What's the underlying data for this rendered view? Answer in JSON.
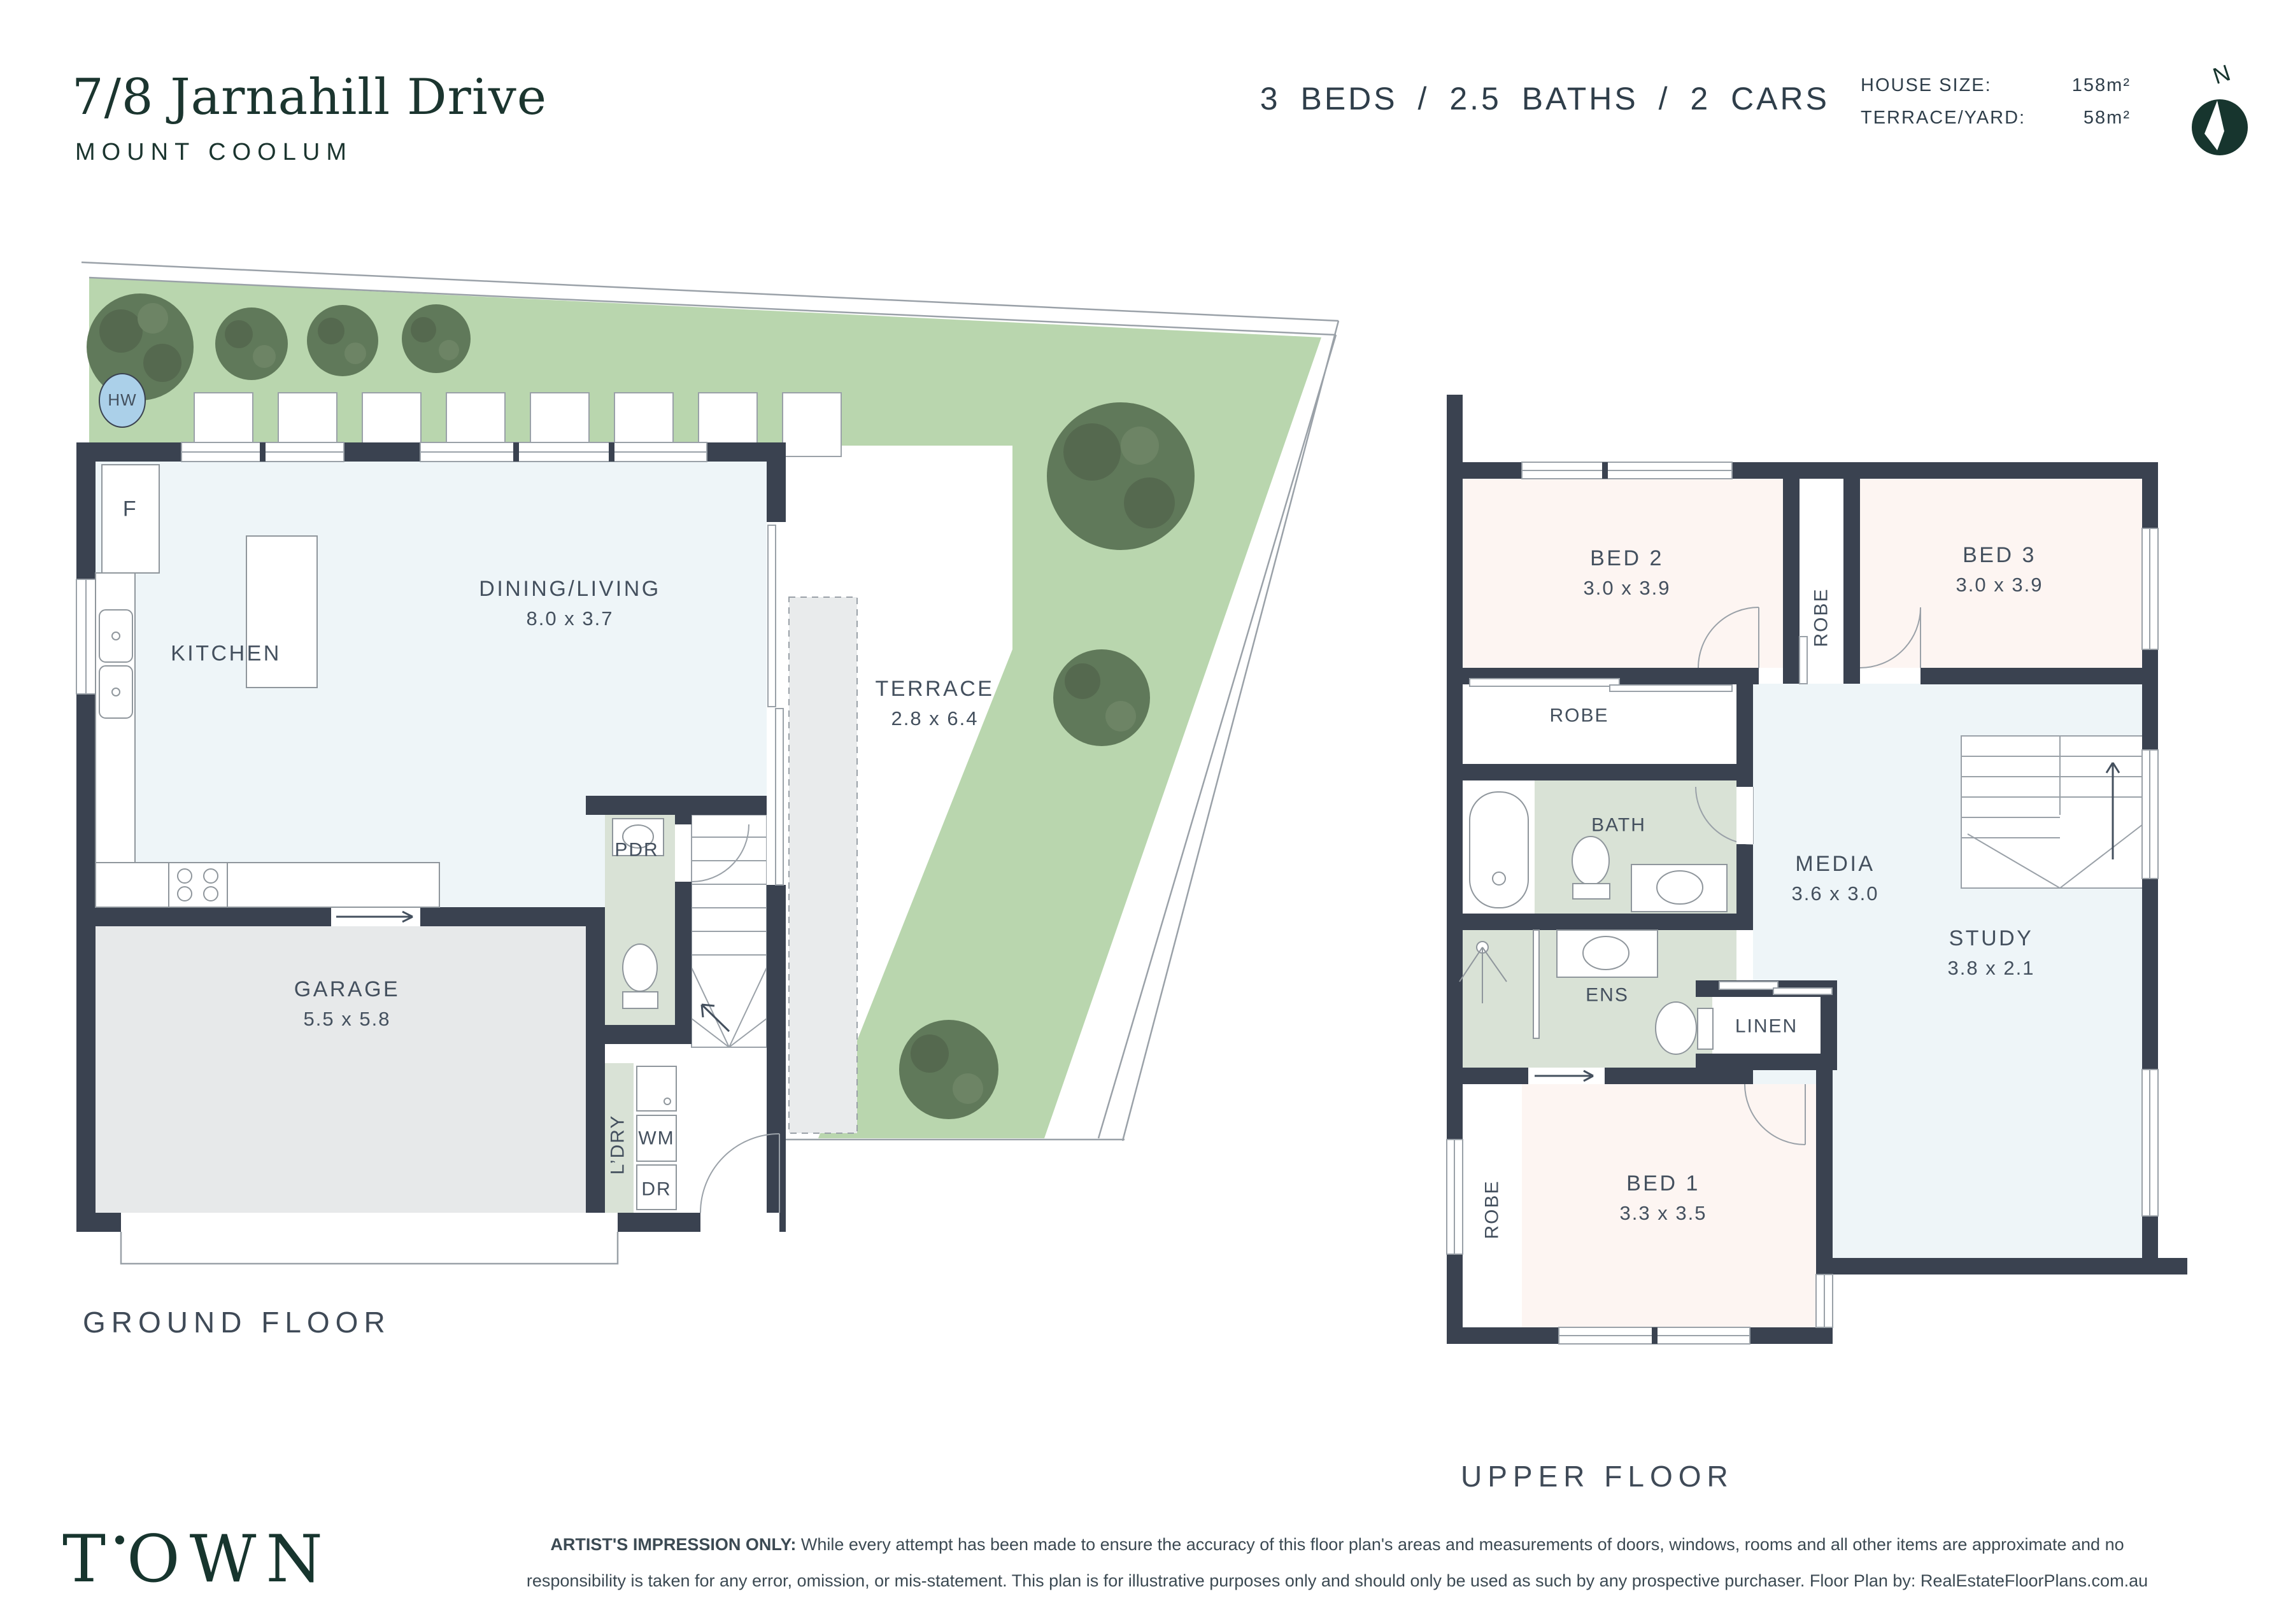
{
  "header": {
    "address_line1": "7/8 Jarnahill Drive",
    "address_line2": "MOUNT COOLUM",
    "summary": "3 BEDS / 2.5 BATHS / 2 CARS",
    "house_size_label": "HOUSE SIZE:",
    "house_size_value": "158m²",
    "terrace_label": "TERRACE/YARD:",
    "terrace_value": "58m²",
    "north_label": "N"
  },
  "ground_floor": {
    "title": "GROUND FLOOR",
    "rooms": {
      "kitchen": {
        "name": "KITCHEN"
      },
      "dining": {
        "name": "DINING/LIVING",
        "dims": "8.0 x 3.7"
      },
      "terrace": {
        "name": "TERRACE",
        "dims": "2.8 x 6.4"
      },
      "garage": {
        "name": "GARAGE",
        "dims": "5.5 x 5.8"
      },
      "pdr": {
        "name": "PDR"
      },
      "ldry": {
        "name": "L’DRY"
      },
      "wm": {
        "name": "WM"
      },
      "dr": {
        "name": "DR"
      },
      "fridge": {
        "name": "F"
      },
      "hw": {
        "name": "HW"
      }
    }
  },
  "upper_floor": {
    "title": "UPPER FLOOR",
    "rooms": {
      "bed1": {
        "name": "BED 1",
        "dims": "3.3 x 3.5"
      },
      "bed2": {
        "name": "BED 2",
        "dims": "3.0 x 3.9"
      },
      "bed3": {
        "name": "BED 3",
        "dims": "3.0 x 3.9"
      },
      "media": {
        "name": "MEDIA",
        "dims": "3.6 x 3.0"
      },
      "study": {
        "name": "STUDY",
        "dims": "3.8 x 2.1"
      },
      "bath": {
        "name": "BATH"
      },
      "ens": {
        "name": "ENS"
      },
      "linen": {
        "name": "LINEN"
      },
      "robe_corridor": {
        "name": "ROBE"
      },
      "robe_bed2": {
        "name": "ROBE"
      },
      "robe_bed1": {
        "name": "ROBE"
      }
    }
  },
  "footer": {
    "logo_t": "T",
    "logo_rest": "OWN",
    "disclaimer_prefix": "ARTIST'S IMPRESSION ONLY:",
    "disclaimer_line1": "While every attempt has been made to ensure the accuracy of this floor plan's areas and measurements of doors, windows, rooms and all other items are approximate and no",
    "disclaimer_line2": "responsibility is taken for any error, omission, or mis-statement. This plan is for illustrative purposes only and should only be used as such by any prospective purchaser. Floor Plan by: RealEstateFloorPlans.com.au"
  },
  "colors": {
    "wall": "#3a4250",
    "brand_green": "#17352e",
    "garden_green": "#b9d6ae",
    "tree_green": "#60795a",
    "floor_living": "#eef5f8",
    "floor_bedroom": "#fdf5f2",
    "floor_wet": "#d9e2d6",
    "floor_garage": "#e7e9ea",
    "hw_blue": "#abd0e9",
    "label_text": "#44505e"
  }
}
